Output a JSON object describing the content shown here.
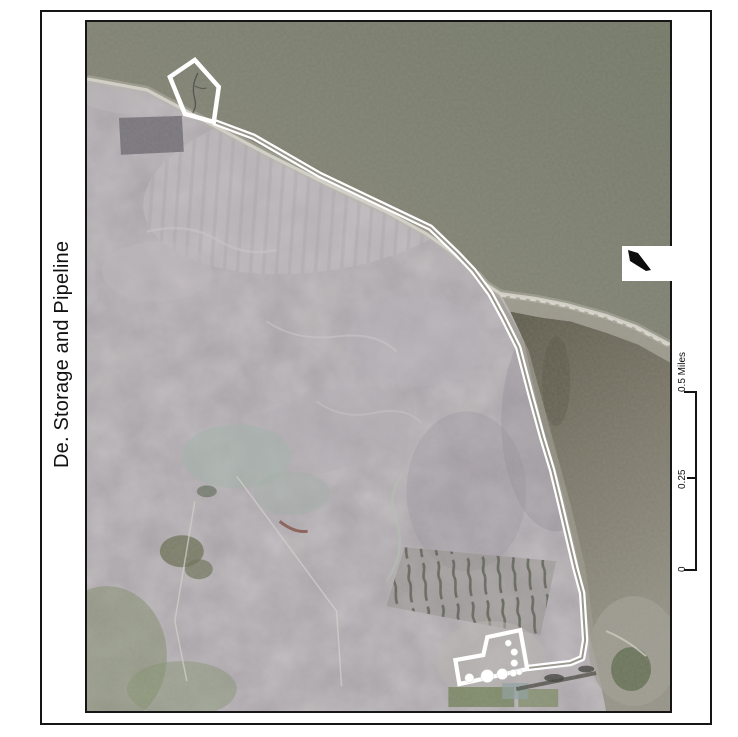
{
  "map": {
    "title": "De. Storage and Pipeline",
    "type": "aerial-imagery-map-layout"
  },
  "scale_bar": {
    "labels": [
      "0",
      "0.25",
      "0.5 Miles"
    ],
    "values": [
      0,
      0.25,
      0.5
    ],
    "units": "Miles",
    "orientation": "vertical-rotated"
  },
  "north_arrow": {
    "icon": "north-arrow",
    "direction": "upper-left"
  },
  "colors": {
    "frame_border": "#151515",
    "map_border": "#151515",
    "bay_water_near": "#8d8c7e",
    "bay_water_far": "#737866",
    "lagoon_water_dark": "#5f5c4c",
    "lagoon_water_light": "#969387",
    "land_base": "#a7a0a6",
    "beach": "#d6d3c9",
    "pipeline_outline": "#ffffff",
    "facility_outline": "#ffffff",
    "vegetation": "#7d8a64"
  }
}
